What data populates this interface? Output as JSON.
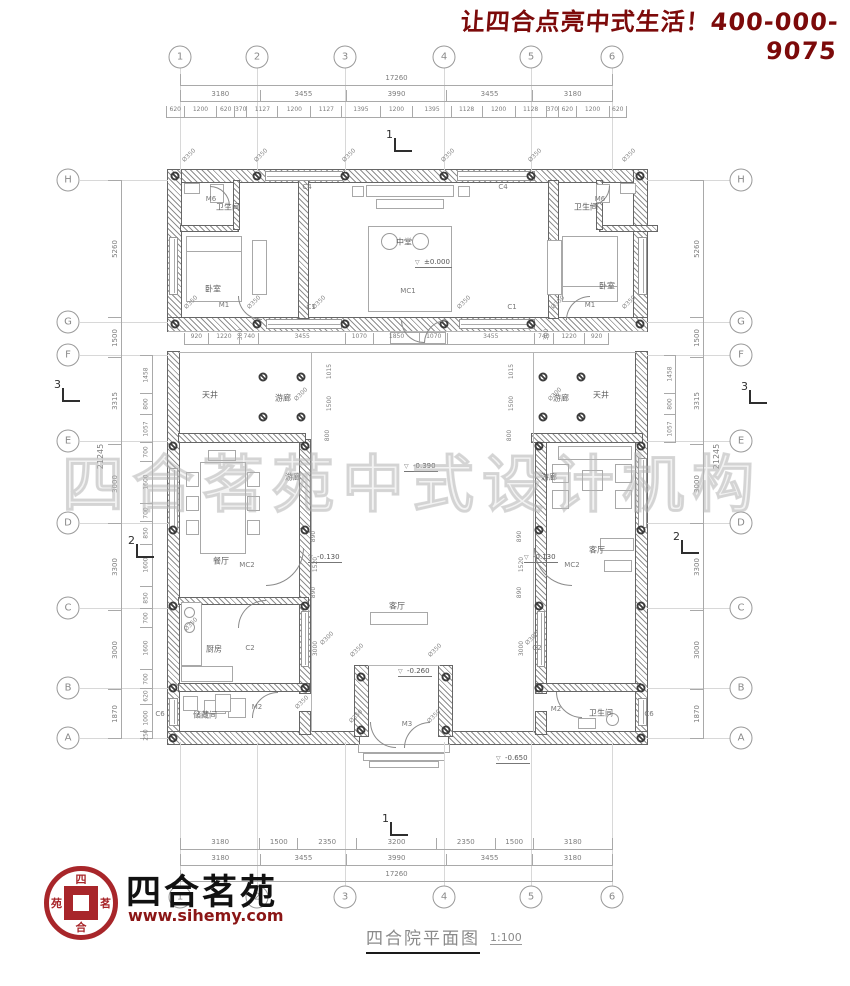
{
  "slogan": {
    "text": "让四合点亮中式生活！400-000-9075",
    "color": "#7c0a0a"
  },
  "watermark": {
    "text": "四合茗苑中式设计机构"
  },
  "titleblock": {
    "title": "四合院平面图",
    "scale": "1:100"
  },
  "brand": {
    "name": "四合茗苑",
    "site": "www.sihemy.com",
    "seal_chars": [
      "四",
      "茗",
      "合",
      "苑"
    ],
    "seal_color": "#a8262a"
  },
  "grid": {
    "cols": [
      {
        "label": "1",
        "x": 180
      },
      {
        "label": "2",
        "x": 257
      },
      {
        "label": "3",
        "x": 345
      },
      {
        "label": "4",
        "x": 444
      },
      {
        "label": "5",
        "x": 531
      },
      {
        "label": "6",
        "x": 612
      }
    ],
    "rows": [
      {
        "label": "H",
        "y": 180
      },
      {
        "label": "G",
        "y": 322
      },
      {
        "label": "F",
        "y": 355
      },
      {
        "label": "E",
        "y": 441
      },
      {
        "label": "D",
        "y": 523
      },
      {
        "label": "C",
        "y": 608
      },
      {
        "label": "B",
        "y": 688
      },
      {
        "label": "A",
        "y": 738
      }
    ]
  },
  "dims": {
    "top_total": [
      "17260"
    ],
    "top_majors": [
      "3180",
      "3455",
      "3990",
      "3455",
      "3180"
    ],
    "top_minors": [
      "620",
      "1200",
      "620",
      "370",
      "1127",
      "1200",
      "1127",
      "1395",
      "1200",
      "1395",
      "1128",
      "1200",
      "1128",
      "370",
      "620",
      "1200",
      "620"
    ],
    "porch_row": [
      "920",
      "1220",
      "740",
      "3455",
      "1070",
      "1850",
      "1070",
      "3455",
      "740",
      "1220",
      "920"
    ],
    "bottom_minors": [
      "3180",
      "1500",
      "2350",
      "3200",
      "2350",
      "1500",
      "3180"
    ],
    "bottom_majors": [
      "3180",
      "3455",
      "3990",
      "3455",
      "3180"
    ],
    "bottom_total": [
      "17260"
    ],
    "left_majors": [
      "5260",
      "1500",
      "3315",
      "3000",
      "3300",
      "3000",
      "1870"
    ],
    "left_total": "21245",
    "left_inner": [
      "1458",
      "800",
      "1057",
      "700",
      "1600",
      "700",
      "850",
      "1600",
      "850",
      "700",
      "1600",
      "700",
      "620",
      "1000",
      "250"
    ],
    "right_majors": [
      "5260",
      "1500",
      "3315",
      "3000",
      "3300",
      "3000",
      "1870"
    ],
    "right_total": "21245",
    "right_inner_fe": [
      "1458",
      "800",
      "1057"
    ],
    "interior_vertical": [
      {
        "v": "1015",
        "x": 330,
        "y": 368
      },
      {
        "v": "1500",
        "x": 330,
        "y": 400
      },
      {
        "v": "800",
        "x": 330,
        "y": 432
      },
      {
        "v": "1015",
        "x": 512,
        "y": 368
      },
      {
        "v": "1500",
        "x": 512,
        "y": 400
      },
      {
        "v": "800",
        "x": 512,
        "y": 432
      },
      {
        "v": "890",
        "x": 316,
        "y": 533
      },
      {
        "v": "1520",
        "x": 316,
        "y": 561
      },
      {
        "v": "890",
        "x": 316,
        "y": 589
      },
      {
        "v": "3000",
        "x": 316,
        "y": 645
      },
      {
        "v": "890",
        "x": 522,
        "y": 533
      },
      {
        "v": "1520",
        "x": 522,
        "y": 561
      },
      {
        "v": "890",
        "x": 522,
        "y": 589
      },
      {
        "v": "3000",
        "x": 522,
        "y": 645
      },
      {
        "v": "300",
        "x": 243,
        "y": 331
      },
      {
        "v": "300",
        "x": 549,
        "y": 331
      }
    ]
  },
  "plan": {
    "rooms": [
      {
        "label": "卫生间",
        "x": 228,
        "y": 207
      },
      {
        "label": "卫生间",
        "x": 586,
        "y": 207
      },
      {
        "label": "卧室",
        "x": 213,
        "y": 289
      },
      {
        "label": "卧室",
        "x": 607,
        "y": 286
      },
      {
        "label": "中堂",
        "x": 404,
        "y": 242
      },
      {
        "label": "天井",
        "x": 210,
        "y": 395
      },
      {
        "label": "天井",
        "x": 601,
        "y": 395
      },
      {
        "label": "游廊",
        "x": 283,
        "y": 398
      },
      {
        "label": "游廊",
        "x": 561,
        "y": 398
      },
      {
        "label": "游廊",
        "x": 293,
        "y": 477
      },
      {
        "label": "游廊",
        "x": 549,
        "y": 477
      },
      {
        "label": "餐厅",
        "x": 221,
        "y": 561
      },
      {
        "label": "厨房",
        "x": 214,
        "y": 649
      },
      {
        "label": "储藏间",
        "x": 205,
        "y": 715
      },
      {
        "label": "客厅",
        "x": 597,
        "y": 550
      },
      {
        "label": "客厅",
        "x": 397,
        "y": 606
      },
      {
        "label": "卫生间",
        "x": 601,
        "y": 713
      }
    ],
    "openings": [
      {
        "code": "M6",
        "x": 211,
        "y": 199
      },
      {
        "code": "M6",
        "x": 600,
        "y": 199
      },
      {
        "code": "M1",
        "x": 224,
        "y": 305
      },
      {
        "code": "M1",
        "x": 590,
        "y": 305
      },
      {
        "code": "MC1",
        "x": 408,
        "y": 291
      },
      {
        "code": "C4",
        "x": 307,
        "y": 187
      },
      {
        "code": "C4",
        "x": 503,
        "y": 187
      },
      {
        "code": "C1",
        "x": 311,
        "y": 307
      },
      {
        "code": "C1",
        "x": 512,
        "y": 307
      },
      {
        "code": "MC2",
        "x": 247,
        "y": 565
      },
      {
        "code": "MC2",
        "x": 572,
        "y": 565
      },
      {
        "code": "C2",
        "x": 250,
        "y": 648
      },
      {
        "code": "C2",
        "x": 537,
        "y": 648
      },
      {
        "code": "M2",
        "x": 257,
        "y": 707
      },
      {
        "code": "M2",
        "x": 556,
        "y": 709
      },
      {
        "code": "M3",
        "x": 407,
        "y": 724
      },
      {
        "code": "C6",
        "x": 160,
        "y": 714
      },
      {
        "code": "C6",
        "x": 649,
        "y": 714
      }
    ],
    "levels": [
      {
        "value": "±0.000",
        "x": 415,
        "y": 258
      },
      {
        "value": "-0.390",
        "x": 404,
        "y": 462
      },
      {
        "value": "-0.130",
        "x": 308,
        "y": 553
      },
      {
        "value": "-0.130",
        "x": 524,
        "y": 553
      },
      {
        "value": "-0.260",
        "x": 398,
        "y": 667
      },
      {
        "value": "-0.650",
        "x": 496,
        "y": 754
      }
    ],
    "phi350_label": "Ø350",
    "phi300_label": "Ø300",
    "phi350": [
      [
        181,
        152
      ],
      [
        253,
        152
      ],
      [
        341,
        152
      ],
      [
        440,
        152
      ],
      [
        527,
        152
      ],
      [
        621,
        152
      ],
      [
        183,
        299
      ],
      [
        246,
        299
      ],
      [
        311,
        299
      ],
      [
        456,
        299
      ],
      [
        550,
        299
      ],
      [
        621,
        299
      ],
      [
        349,
        647
      ],
      [
        427,
        647
      ],
      [
        348,
        713
      ],
      [
        426,
        713
      ],
      [
        183,
        621
      ],
      [
        294,
        699
      ]
    ],
    "phi300": [
      [
        293,
        391
      ],
      [
        547,
        391
      ],
      [
        319,
        635
      ],
      [
        524,
        635
      ]
    ],
    "sections": [
      {
        "n": "1",
        "x": 386,
        "y": 128
      },
      {
        "n": "1",
        "x": 382,
        "y": 812
      },
      {
        "n": "2",
        "x": 128,
        "y": 534
      },
      {
        "n": "2",
        "x": 673,
        "y": 530
      },
      {
        "n": "3",
        "x": 54,
        "y": 378
      },
      {
        "n": "3",
        "x": 741,
        "y": 380
      }
    ]
  },
  "geometry": {
    "walls": [
      [
        168,
        170,
        479,
        12
      ],
      [
        168,
        170,
        13,
        161
      ],
      [
        634,
        170,
        13,
        161
      ],
      [
        168,
        318,
        479,
        13
      ],
      [
        299,
        181,
        9,
        137
      ],
      [
        549,
        181,
        9,
        137
      ],
      [
        181,
        226,
        57,
        5
      ],
      [
        234,
        181,
        5,
        48
      ],
      [
        600,
        226,
        57,
        5
      ],
      [
        597,
        181,
        5,
        48
      ],
      [
        168,
        352,
        11,
        392
      ],
      [
        636,
        352,
        11,
        392
      ],
      [
        168,
        732,
        191,
        12
      ],
      [
        449,
        732,
        198,
        12
      ],
      [
        300,
        440,
        10,
        253
      ],
      [
        536,
        440,
        10,
        253
      ],
      [
        300,
        712,
        10,
        22
      ],
      [
        536,
        712,
        10,
        22
      ],
      [
        179,
        434,
        126,
        8
      ],
      [
        532,
        434,
        110,
        8
      ],
      [
        179,
        598,
        129,
        6
      ],
      [
        179,
        684,
        130,
        7
      ],
      [
        536,
        684,
        104,
        7
      ],
      [
        355,
        666,
        13,
        70
      ],
      [
        439,
        666,
        13,
        70
      ]
    ],
    "lines": [
      [
        179,
        352,
        458,
        1
      ],
      [
        311,
        353,
        1,
        379
      ],
      [
        533,
        353,
        1,
        379
      ],
      [
        368,
        665,
        72,
        1
      ],
      [
        168,
        331,
        479,
        1
      ]
    ],
    "windows": [
      [
        265,
        171,
        78,
        10,
        "h"
      ],
      [
        457,
        171,
        78,
        10,
        "h"
      ],
      [
        266,
        319,
        76,
        10,
        "h"
      ],
      [
        459,
        319,
        76,
        10,
        "h"
      ],
      [
        169,
        237,
        9,
        58,
        "v"
      ],
      [
        638,
        237,
        9,
        58,
        "v"
      ],
      [
        169,
        468,
        9,
        62,
        "v"
      ],
      [
        638,
        458,
        9,
        70,
        "v"
      ],
      [
        301,
        611,
        8,
        56,
        "v"
      ],
      [
        537,
        611,
        8,
        56,
        "v"
      ],
      [
        169,
        698,
        9,
        28,
        "v"
      ],
      [
        638,
        698,
        9,
        28,
        "v"
      ]
    ],
    "furniture": [
      [
        186,
        236,
        56,
        66
      ],
      [
        186,
        236,
        56,
        16
      ],
      [
        252,
        240,
        15,
        55
      ],
      [
        562,
        236,
        56,
        66
      ],
      [
        562,
        286,
        56,
        16
      ],
      [
        547,
        240,
        15,
        55
      ],
      [
        366,
        185,
        88,
        12
      ],
      [
        376,
        199,
        68,
        10
      ],
      [
        352,
        186,
        12,
        11
      ],
      [
        458,
        186,
        12,
        11
      ],
      [
        368,
        226,
        84,
        86
      ],
      [
        200,
        462,
        46,
        92
      ],
      [
        186,
        472,
        13,
        15
      ],
      [
        186,
        496,
        13,
        15
      ],
      [
        186,
        520,
        13,
        15
      ],
      [
        247,
        472,
        13,
        15
      ],
      [
        247,
        496,
        13,
        15
      ],
      [
        247,
        520,
        13,
        15
      ],
      [
        208,
        450,
        28,
        11
      ],
      [
        181,
        602,
        21,
        64
      ],
      [
        181,
        666,
        52,
        16
      ],
      [
        228,
        698,
        18,
        20
      ],
      [
        204,
        700,
        22,
        14
      ],
      [
        558,
        446,
        74,
        14
      ],
      [
        552,
        464,
        17,
        19
      ],
      [
        552,
        490,
        17,
        19
      ],
      [
        615,
        464,
        17,
        19
      ],
      [
        615,
        490,
        17,
        19
      ],
      [
        582,
        470,
        21,
        21
      ],
      [
        600,
        538,
        34,
        13
      ],
      [
        604,
        560,
        28,
        12
      ],
      [
        183,
        696,
        15,
        15
      ],
      [
        215,
        694,
        16,
        18
      ],
      [
        578,
        718,
        18,
        11
      ],
      [
        370,
        612,
        58,
        13
      ],
      [
        390,
        332,
        56,
        12
      ],
      [
        358,
        744,
        92,
        9
      ],
      [
        363,
        753,
        82,
        8
      ],
      [
        369,
        761,
        70,
        7
      ],
      [
        184,
        183,
        16,
        11
      ],
      [
        210,
        184,
        14,
        19
      ],
      [
        620,
        183,
        16,
        11
      ],
      [
        596,
        184,
        14,
        19
      ]
    ],
    "circles": [
      [
        389,
        241,
        17
      ],
      [
        420,
        241,
        17
      ],
      [
        189,
        612,
        11
      ],
      [
        189,
        627,
        11
      ],
      [
        612,
        719,
        13
      ]
    ],
    "columns": [
      [
        175,
        176
      ],
      [
        257,
        176
      ],
      [
        345,
        176
      ],
      [
        444,
        176
      ],
      [
        531,
        176
      ],
      [
        640,
        176
      ],
      [
        175,
        324
      ],
      [
        257,
        324
      ],
      [
        345,
        324
      ],
      [
        444,
        324
      ],
      [
        531,
        324
      ],
      [
        640,
        324
      ],
      [
        263,
        377
      ],
      [
        301,
        377
      ],
      [
        543,
        377
      ],
      [
        581,
        377
      ],
      [
        263,
        417
      ],
      [
        301,
        417
      ],
      [
        543,
        417
      ],
      [
        581,
        417
      ],
      [
        305,
        446
      ],
      [
        305,
        530
      ],
      [
        305,
        606
      ],
      [
        305,
        688
      ],
      [
        539,
        446
      ],
      [
        539,
        530
      ],
      [
        539,
        606
      ],
      [
        539,
        688
      ],
      [
        173,
        446
      ],
      [
        173,
        530
      ],
      [
        173,
        606
      ],
      [
        173,
        688
      ],
      [
        173,
        738
      ],
      [
        641,
        446
      ],
      [
        641,
        530
      ],
      [
        641,
        606
      ],
      [
        641,
        688
      ],
      [
        641,
        738
      ],
      [
        361,
        677
      ],
      [
        446,
        677
      ],
      [
        361,
        730
      ],
      [
        446,
        730
      ]
    ],
    "arcs": [
      [
        210,
        186,
        20,
        90
      ],
      [
        590,
        186,
        20,
        180
      ],
      [
        238,
        296,
        24,
        270
      ],
      [
        566,
        296,
        24,
        0
      ],
      [
        401,
        320,
        23,
        270
      ],
      [
        424,
        320,
        23,
        0
      ],
      [
        266,
        548,
        38,
        180
      ],
      [
        534,
        548,
        38,
        270
      ],
      [
        252,
        692,
        26,
        0
      ],
      [
        556,
        692,
        26,
        270
      ],
      [
        370,
        722,
        26,
        270
      ],
      [
        404,
        722,
        26,
        0
      ],
      [
        238,
        600,
        28,
        0
      ]
    ]
  }
}
